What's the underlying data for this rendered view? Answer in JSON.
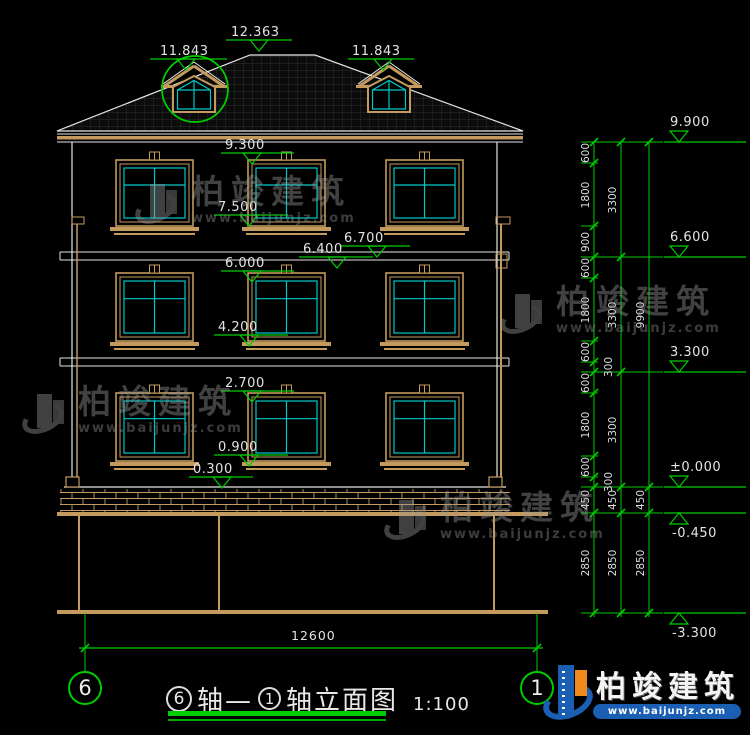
{
  "title": {
    "axis_start": "6",
    "joiner": "轴—",
    "axis_end": "1",
    "suffix": "轴立面图",
    "scale": "1:100"
  },
  "axis_bubbles": [
    {
      "label": "6"
    },
    {
      "label": "1"
    }
  ],
  "building_levels": [
    {
      "label": "12.363",
      "tx": 231,
      "ty": 25,
      "lx1": 226,
      "lx2": 292,
      "ly": 40,
      "trx": 250
    },
    {
      "label": "11.843",
      "tx": 160,
      "ty": 44,
      "lx1": 150,
      "lx2": 227,
      "ly": 59,
      "trx": 177
    },
    {
      "label": "11.843",
      "tx": 352,
      "ty": 44,
      "lx1": 348,
      "lx2": 414,
      "ly": 59,
      "trx": 374
    },
    {
      "label": "9.300",
      "tx": 225,
      "ty": 138,
      "lx1": 221,
      "lx2": 294,
      "ly": 153,
      "trx": 243
    },
    {
      "label": "7.500",
      "tx": 218,
      "ty": 200,
      "lx1": 214,
      "lx2": 288,
      "ly": 215,
      "trx": 240
    },
    {
      "label": "6.700",
      "tx": 344,
      "ty": 231,
      "lx1": 340,
      "lx2": 410,
      "ly": 246,
      "trx": 368
    },
    {
      "label": "6.400",
      "tx": 303,
      "ty": 242,
      "lx1": 299,
      "lx2": 373,
      "ly": 257,
      "trx": 328
    },
    {
      "label": "6.000",
      "tx": 225,
      "ty": 256,
      "lx1": 221,
      "lx2": 294,
      "ly": 271,
      "trx": 243
    },
    {
      "label": "4.200",
      "tx": 218,
      "ty": 320,
      "lx1": 214,
      "lx2": 288,
      "ly": 335,
      "trx": 240
    },
    {
      "label": "2.700",
      "tx": 225,
      "ty": 376,
      "lx1": 221,
      "lx2": 294,
      "ly": 391,
      "trx": 243
    },
    {
      "label": "0.900",
      "tx": 218,
      "ty": 440,
      "lx1": 214,
      "lx2": 288,
      "ly": 455,
      "trx": 240
    },
    {
      "label": "0.300",
      "tx": 193,
      "ty": 462,
      "lx1": 189,
      "lx2": 253,
      "ly": 477,
      "trx": 213
    }
  ],
  "right_levels": [
    {
      "label": "9.900",
      "y": 142,
      "neg": false
    },
    {
      "label": "6.600",
      "y": 257,
      "neg": false
    },
    {
      "label": "3.300",
      "y": 372,
      "neg": false
    },
    {
      "label": "±0.000",
      "y": 487,
      "neg": false
    },
    {
      "label": "-0.450",
      "y": 513,
      "neg": true
    },
    {
      "label": "-3.300",
      "y": 613,
      "neg": true
    }
  ],
  "dim_chains": [
    {
      "x": 594,
      "ticks": [
        142,
        163,
        226,
        257,
        278,
        341,
        362,
        372,
        393,
        456,
        477,
        487,
        513,
        613
      ],
      "labels": [
        "600",
        "1800",
        "900",
        "600",
        "1800",
        "600",
        "300",
        "600",
        "1800",
        "600",
        "300",
        "450",
        "2850"
      ],
      "offsets": [
        0,
        0,
        0,
        0,
        0,
        0,
        15,
        0,
        0,
        0,
        15,
        0,
        0
      ]
    },
    {
      "x": 621,
      "ticks": [
        142,
        257,
        372,
        487,
        513,
        613
      ],
      "labels": [
        "3300",
        "3300",
        "3300",
        "450",
        "2850"
      ],
      "offsets": [
        0,
        0,
        0,
        0,
        0
      ]
    },
    {
      "x": 649,
      "ticks": [
        142,
        487,
        513,
        613
      ],
      "labels": [
        "9900",
        "450",
        "2850"
      ],
      "offsets": [
        0,
        0,
        0
      ]
    }
  ],
  "width_dim": {
    "label": "12600",
    "x1": 85,
    "x2": 537,
    "y": 648,
    "ext_top": 613,
    "label_x": 291,
    "label_y": 628
  },
  "watermark": {
    "name": "柏竣建筑",
    "url": "www.baijunjz.com"
  },
  "brand": {
    "name": "柏竣建筑",
    "url": "www.baijunjz.com"
  },
  "colors": {
    "background": "#000000",
    "outline": "#e6e6e6",
    "wood": "#c49a5e",
    "glass": "#00c8c8",
    "dim_green": "#00cc00",
    "text": "#e3e3e3",
    "brand_blue": "#1a5fb4",
    "brand_orange": "#ee8a1e"
  }
}
